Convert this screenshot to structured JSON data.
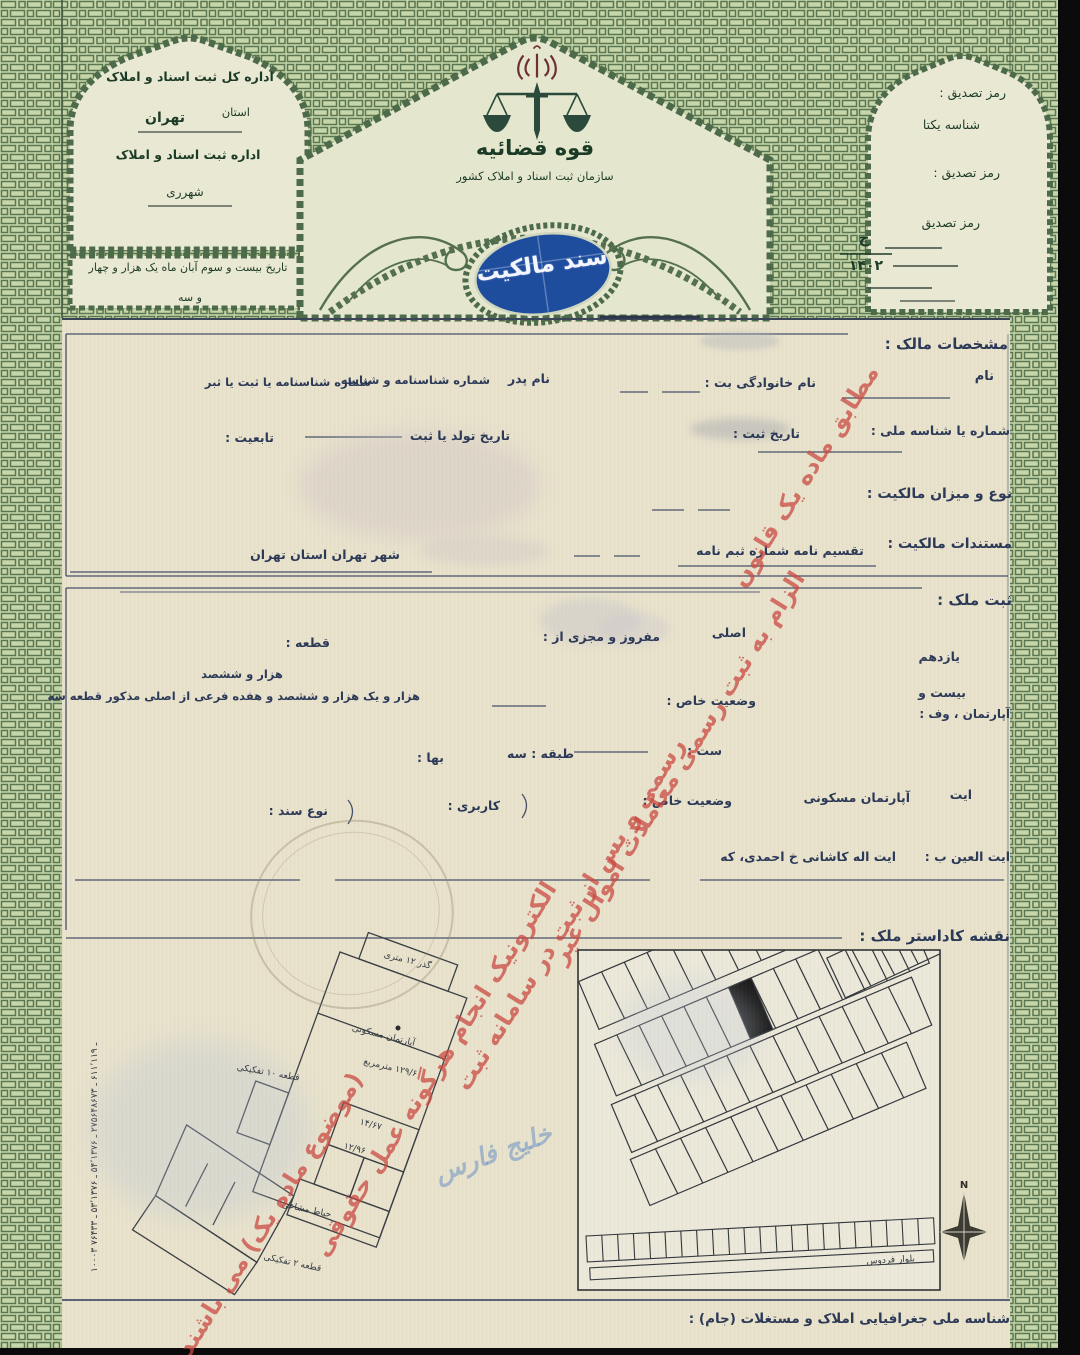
{
  "header": {
    "left_box": {
      "dept": "اداره کل ثبت اسناد و املاک",
      "province_label": "استان",
      "province": "تهران",
      "office": "اداره ثبت اسناد و املاک",
      "district": "شهرری",
      "date_line1": "تاریخ بیست و سوم آبان ماه یک هزار و چهار",
      "date_line2": "و سه"
    },
    "center": {
      "authority": "قوه قضائیه",
      "organization": "سازمان ثبت اسناد و املاک کشور",
      "seal": "سند مالکیت"
    },
    "right_box": {
      "verify1": "رمز تصدیق :",
      "unique_id": "شناسه یکتا",
      "verify2": "رمز تصدیق :",
      "verify3": "رمز تصدیق",
      "series_letter": "ج",
      "series_year": "۱۴۰۲"
    }
  },
  "owner": {
    "section_title": "مشخصات مالک :",
    "name": "نام",
    "family": "نام خانوادگی بت :",
    "father": "نام پدر",
    "id1": "شماره شناسنامه و شناسه",
    "id2": "شماره شناسنامه یا ثبت یا ثبر",
    "national_id": "شماره یا شناسه ملی :",
    "reg_date": "تاریخ ثبت :",
    "birth": "تاریخ تولد یا ثبت",
    "nationality": "تابعیت :",
    "ownership_type": "نوع و میزان مالکیت :",
    "docs": "مستندات مالکیت :",
    "docs_value": "تقسیم نامه شماره ثبم نامه",
    "docs_city": "شهر تهران استان تهران"
  },
  "property": {
    "section_title": "ثبت ملک :",
    "asli": "اصلی",
    "mafruz": "مفروز و مجزی از :",
    "plot": "قطعه :",
    "district11": "یازدهم",
    "twenty": "بیست و",
    "apartment": "آپارتمان ، وف :",
    "special1": "وضعیت خاص :",
    "thousand": "هزار و ششصد",
    "parcel_text": "هزار و یک هزار و ششصد و هفده فرعی از اصلی مذکور قطعه سه",
    "sat": "ست :",
    "floor": "طبقه : سه",
    "price": "بها :",
    "it": "ایت",
    "residential": "آپارتمان مسکونی",
    "special2": "وضعیت خاص :",
    "usage": "کاربری :",
    "deed_type": "نوع سند :",
    "address_label": "ایت العین ب :",
    "address": "ایت اله کاشانی خ احمدی، که"
  },
  "map": {
    "section_title": "نقشه کاداستر ملک :",
    "compass": "N",
    "street": "بلوار فردوس",
    "left_plan": {
      "l1": "گذر ۱۲ متری",
      "l2": "آپارتمان مسکونی",
      "l3": "قطعه ۱۰ تفکیکی",
      "l4": "۱۲۹/۶ مترمربع",
      "l5": "حیاط مشاعی",
      "l6": "قطعه ۲ تفکیکی",
      "n1": "۱۴/۶۷",
      "n2": "۱۲/۹۶",
      "side_numbers": "۱۰۰۰۳ ـ ۶۱۱٬۱۱۹ ـ ۲۷۵۶۴۸۶۷۳ ـ ۵۴٬۱۳۷۶ ـ ۵۳٬۱۳۷۶ ـ ۷۶۴۳۳"
    }
  },
  "footer": {
    "jam": "شناسه ملی جغرافیایی املاک و مستغلات (جام) :"
  },
  "stamp": {
    "l1": "مطابق ماده یک قانون",
    "l2": "الزام به ثبت رسمی معاملات اموال غیر",
    "l3": "رسمی و پس از ثبت در سامانه ثبت",
    "l4": "الکترونیک انجام هرگونه عمل حقوقی",
    "l5": "(موضوع ماده یک) می باشند"
  },
  "watermark": "خلیج فارس"
}
